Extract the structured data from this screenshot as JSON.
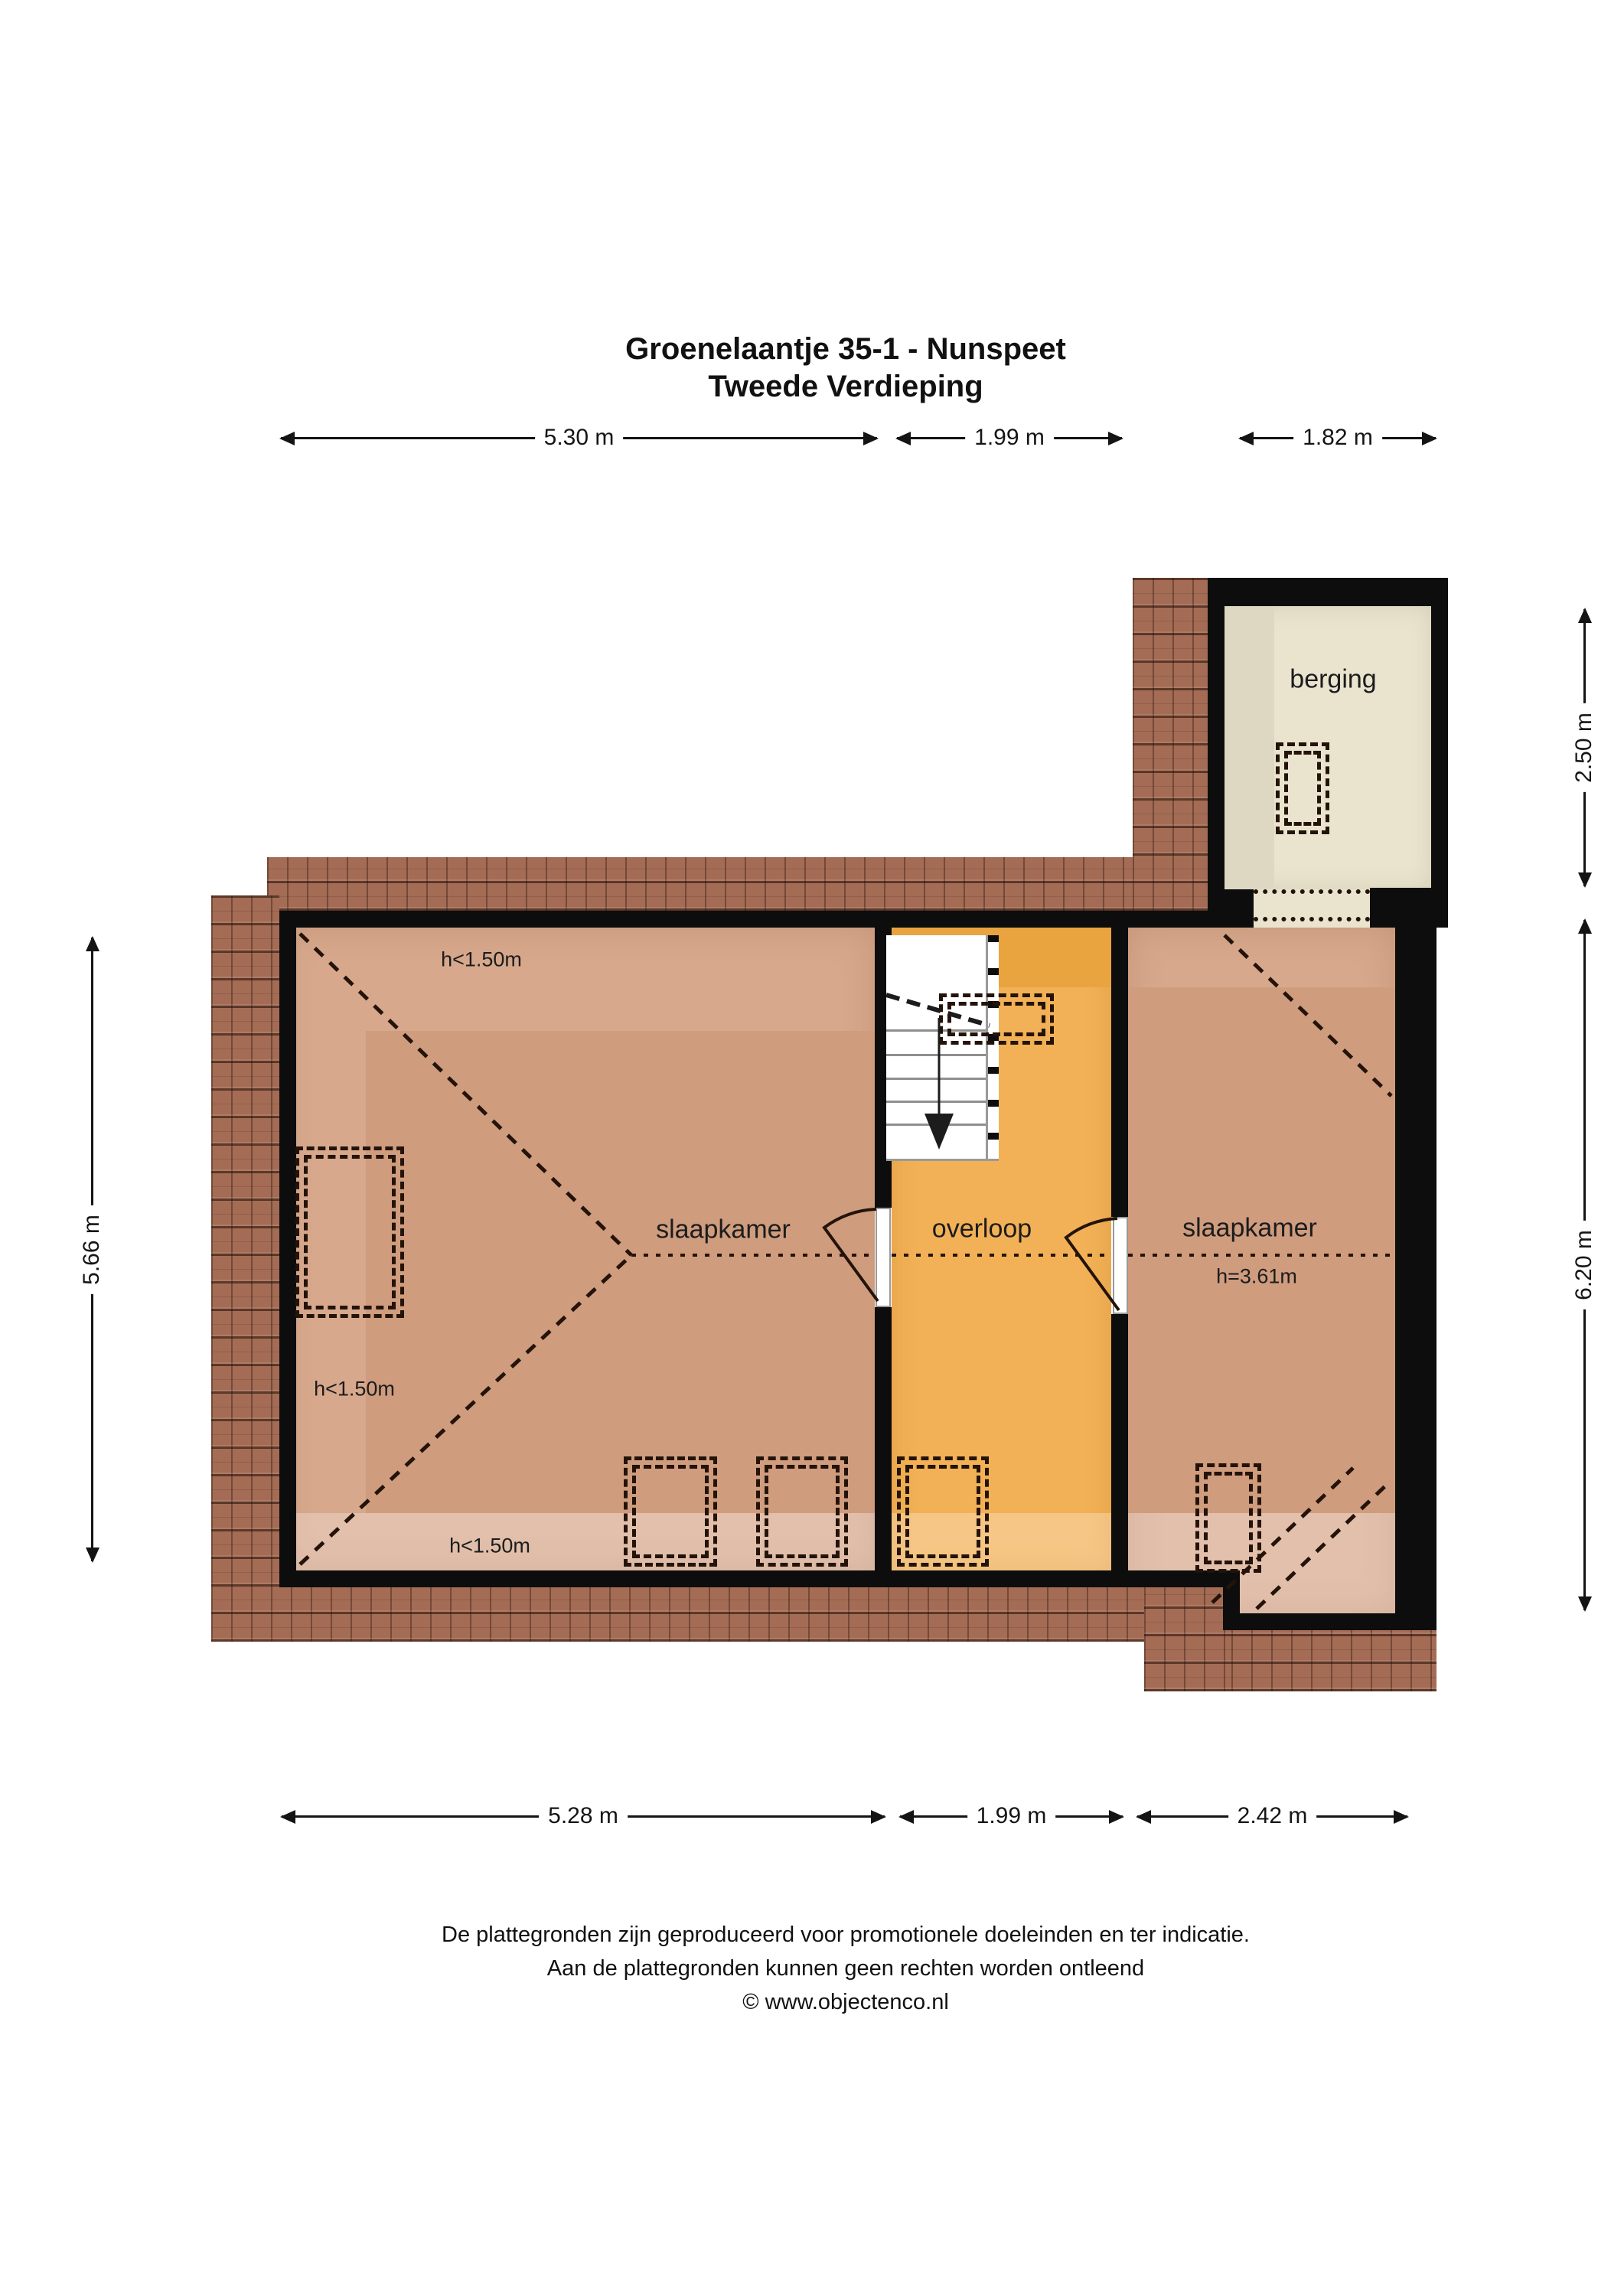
{
  "title": {
    "line1": "Groenelaantje 35-1 - Nunspeet",
    "line2": "Tweede Verdieping"
  },
  "rooms": {
    "bedroom_left": "slaapkamer",
    "landing": "overloop",
    "bedroom_right": "slaapkamer",
    "storage": "berging"
  },
  "annotations": {
    "h_low_top": "h<1.50m",
    "h_low_left": "h<1.50m",
    "h_low_bottom": "h<1.50m",
    "h_ridge_right": "h=3.61m"
  },
  "dimensions": {
    "top": [
      "5.30 m",
      "1.99 m",
      "1.82 m"
    ],
    "bottom": [
      "5.28 m",
      "1.99 m",
      "2.42 m"
    ],
    "left": [
      "5.66 m"
    ],
    "right": [
      "2.50 m",
      "6.20 m"
    ]
  },
  "footer": {
    "line1": "De plattegronden zijn geproduceerd voor promotionele doeleinden en ter indicatie.",
    "line2": "Aan de plattegronden kunnen geen rechten worden ontleend",
    "line3": "© www.objectenco.nl"
  },
  "colors": {
    "wall": "#0d0d0d",
    "tile": "#a46c55",
    "floor_light": "#d7a88c",
    "floor_dark": "#cf9c7e",
    "orange": "#f2b156",
    "orange_dark": "#e9a440",
    "beige": "#eae4cf",
    "beige_dark": "#ded7c1",
    "ink": "#241309"
  }
}
